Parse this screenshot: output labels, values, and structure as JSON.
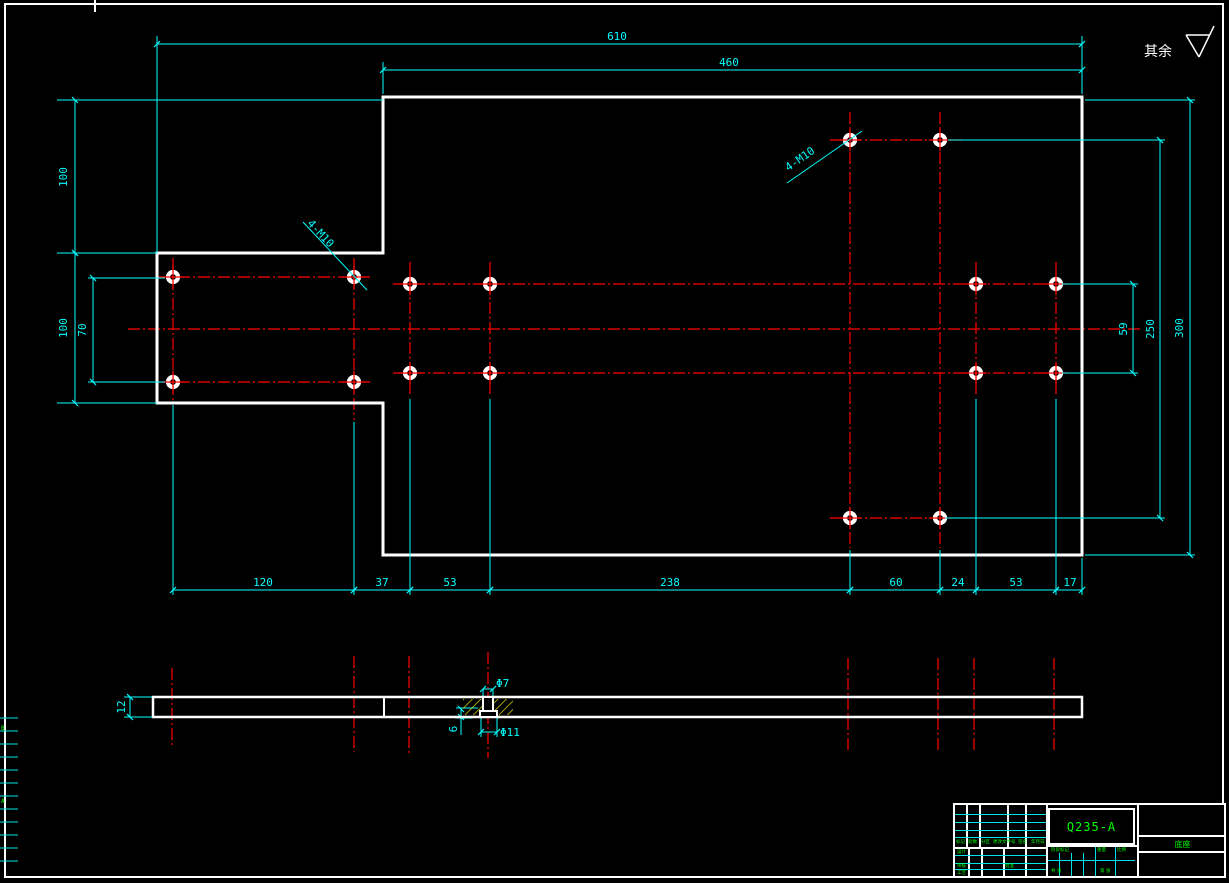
{
  "sheet": {
    "surface_note": "其余",
    "zone_letters": [
      "B",
      "A"
    ]
  },
  "dimensions": {
    "top_total": "610",
    "top_body": "460",
    "left_upper": "100",
    "left_lower": "100",
    "left_hole_spacing": "70",
    "right_hole_spacing": "59",
    "right_row_spacing": "250",
    "right_height": "300",
    "bottom_chain": [
      "120",
      "37",
      "53",
      "238",
      "60",
      "24",
      "53",
      "17"
    ],
    "plate_thickness": "12",
    "hole_top_dia": "Φ7",
    "hole_counterbore_dia": "Φ11",
    "counterbore_depth": "6"
  },
  "callouts": {
    "thread_left": "4-M10",
    "thread_right": "4-M10"
  },
  "title_block": {
    "material": "Q235-A",
    "part_name": "底座",
    "header_row": [
      "标记",
      "处数",
      "分区",
      "更改文件号",
      "签名",
      "年月日"
    ],
    "left_labels": [
      "设计",
      "审核",
      "工艺",
      "批准"
    ],
    "stage_label": "阶段标记",
    "weight_label": "重量",
    "scale_label": "比例",
    "sheet_total": "共 张",
    "sheet_no": "第 张"
  },
  "colors": {
    "background": "#000000",
    "outline": "#ffffff",
    "dimension": "#00ffff",
    "centerline": "#ff0000",
    "hatch": "#ffff00",
    "accent_text": "#00ff00"
  }
}
